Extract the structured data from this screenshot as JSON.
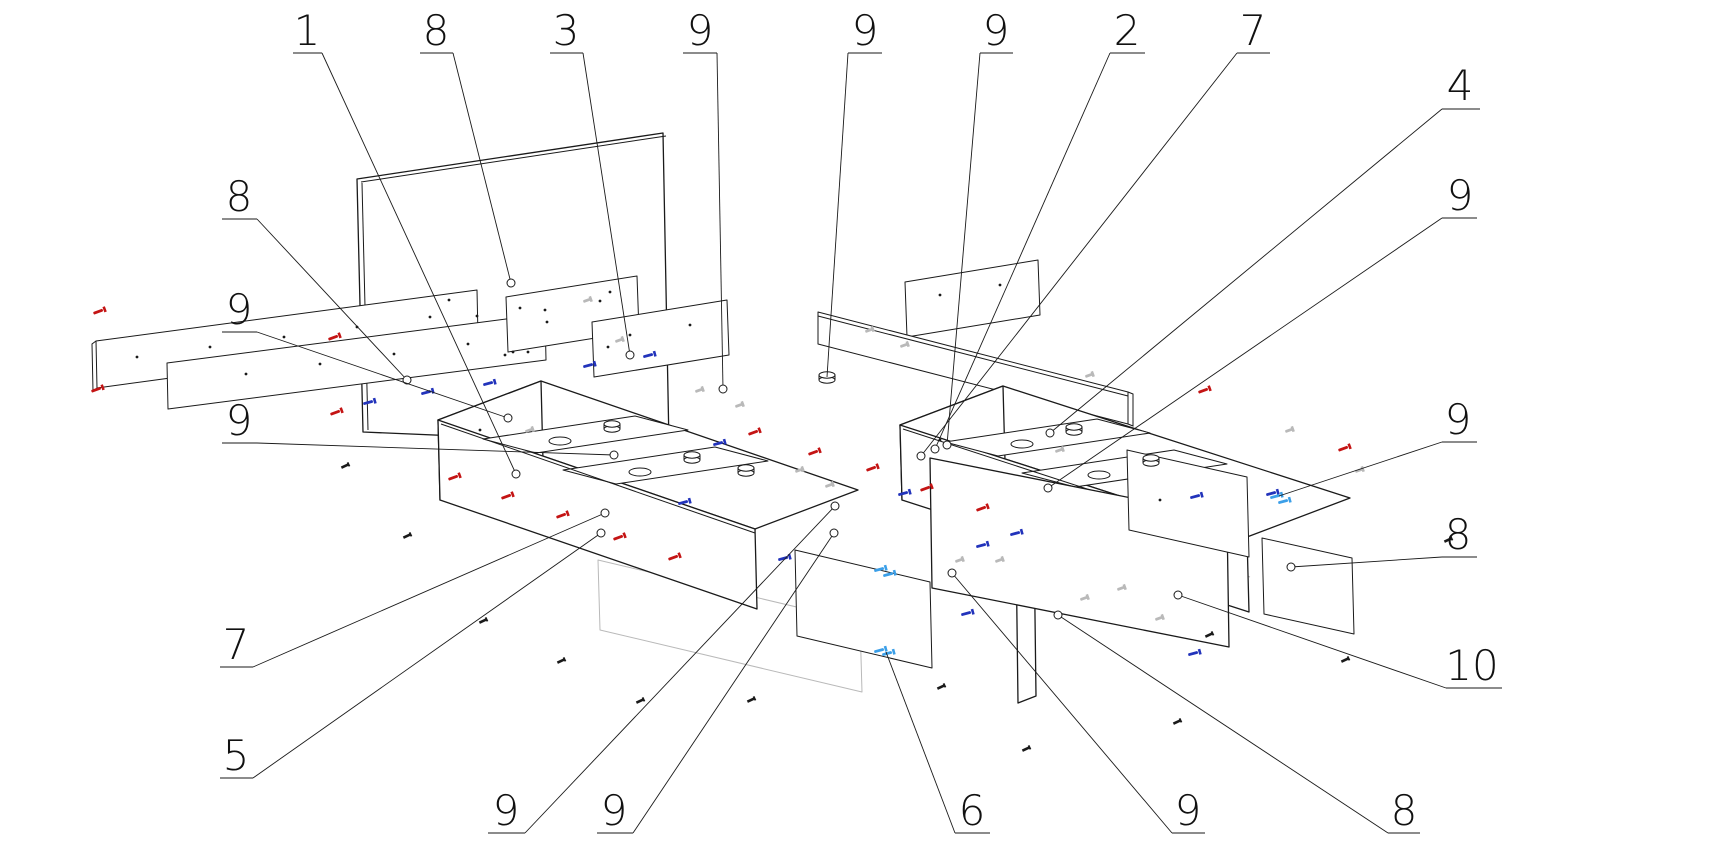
{
  "diagram": {
    "type": "exploded-assembly-technical-drawing",
    "subject": "bed frame with drawer boxes, exploded isometric view",
    "colors": {
      "line": "#1a1a1a",
      "hidden": "#b9b9b9",
      "screw_red": "#c41414",
      "screw_blue": "#2233bb",
      "screw_lightblue": "#3b9fe8",
      "background": "#ffffff"
    },
    "callouts": [
      {
        "label": "1",
        "tx": 307,
        "ty": 45,
        "ux1": 293,
        "ux2": 322,
        "uy": 53,
        "sx": 322,
        "sy": 53,
        "ex": 516,
        "ey": 474,
        "circle": true
      },
      {
        "label": "8",
        "tx": 436,
        "ty": 45,
        "ux1": 420,
        "ux2": 453,
        "uy": 53,
        "sx": 453,
        "sy": 53,
        "ex": 511,
        "ey": 283,
        "circle": true
      },
      {
        "label": "3",
        "tx": 566,
        "ty": 45,
        "ux1": 550,
        "ux2": 583,
        "uy": 53,
        "sx": 583,
        "sy": 53,
        "ex": 630,
        "ey": 355,
        "circle": true
      },
      {
        "label": "9",
        "tx": 700,
        "ty": 45,
        "ux1": 683,
        "ux2": 717,
        "uy": 53,
        "sx": 717,
        "sy": 53,
        "ex": 723,
        "ey": 389,
        "circle": true
      },
      {
        "label": "9",
        "tx": 865,
        "ty": 45,
        "ux1": 848,
        "ux2": 882,
        "uy": 53,
        "sx": 848,
        "sy": 53,
        "ex": 827,
        "ey": 377,
        "circle": false
      },
      {
        "label": "9",
        "tx": 996,
        "ty": 45,
        "ux1": 980,
        "ux2": 1013,
        "uy": 53,
        "sx": 980,
        "sy": 53,
        "ex": 947,
        "ey": 445,
        "circle": true
      },
      {
        "label": "2",
        "tx": 1127,
        "ty": 45,
        "ux1": 1110,
        "ux2": 1145,
        "uy": 53,
        "sx": 1110,
        "sy": 53,
        "ex": 935,
        "ey": 449,
        "circle": true
      },
      {
        "label": "7",
        "tx": 1253,
        "ty": 45,
        "ux1": 1237,
        "ux2": 1270,
        "uy": 53,
        "sx": 1237,
        "sy": 53,
        "ex": 921,
        "ey": 456,
        "circle": true
      },
      {
        "label": "4",
        "tx": 1460,
        "ty": 100,
        "ux1": 1442,
        "ux2": 1480,
        "uy": 109,
        "sx": 1442,
        "sy": 109,
        "ex": 1050,
        "ey": 433,
        "circle": true
      },
      {
        "label": "9",
        "tx": 1460,
        "ty": 210,
        "ux1": 1442,
        "ux2": 1477,
        "uy": 218,
        "sx": 1442,
        "sy": 218,
        "ex": 1048,
        "ey": 488,
        "circle": true
      },
      {
        "label": "9",
        "tx": 1458,
        "ty": 434,
        "ux1": 1442,
        "ux2": 1477,
        "uy": 442,
        "sx": 1442,
        "sy": 442,
        "ex": 1279,
        "ey": 496,
        "circle": false
      },
      {
        "label": "8",
        "tx": 1458,
        "ty": 549,
        "ux1": 1442,
        "ux2": 1477,
        "uy": 557,
        "sx": 1442,
        "sy": 557,
        "ex": 1291,
        "ey": 567,
        "circle": true
      },
      {
        "label": "10",
        "tx": 1472,
        "ty": 680,
        "ux1": 1446,
        "ux2": 1502,
        "uy": 688,
        "sx": 1446,
        "sy": 688,
        "ex": 1178,
        "ey": 595,
        "circle": true
      },
      {
        "label": "8",
        "tx": 239,
        "ty": 211,
        "ux1": 222,
        "ux2": 257,
        "uy": 219,
        "sx": 257,
        "sy": 219,
        "ex": 407,
        "ey": 380,
        "circle": true
      },
      {
        "label": "9",
        "tx": 239,
        "ty": 324,
        "ux1": 222,
        "ux2": 257,
        "uy": 332,
        "sx": 257,
        "sy": 332,
        "ex": 508,
        "ey": 418,
        "circle": true
      },
      {
        "label": "9",
        "tx": 239,
        "ty": 435,
        "ux1": 222,
        "ux2": 257,
        "uy": 443,
        "sx": 257,
        "sy": 443,
        "ex": 614,
        "ey": 455,
        "circle": true
      },
      {
        "label": "7",
        "tx": 236,
        "ty": 659,
        "ux1": 220,
        "ux2": 253,
        "uy": 667,
        "sx": 253,
        "sy": 667,
        "ex": 605,
        "ey": 513,
        "circle": true
      },
      {
        "label": "5",
        "tx": 236,
        "ty": 770,
        "ux1": 220,
        "ux2": 253,
        "uy": 778,
        "sx": 253,
        "sy": 778,
        "ex": 601,
        "ey": 533,
        "circle": true
      },
      {
        "label": "9",
        "tx": 506,
        "ty": 825,
        "ux1": 488,
        "ux2": 525,
        "uy": 833,
        "sx": 525,
        "sy": 833,
        "ex": 835,
        "ey": 506,
        "circle": true
      },
      {
        "label": "9",
        "tx": 614,
        "ty": 825,
        "ux1": 597,
        "ux2": 633,
        "uy": 833,
        "sx": 633,
        "sy": 833,
        "ex": 834,
        "ey": 533,
        "circle": true
      },
      {
        "label": "6",
        "tx": 972,
        "ty": 825,
        "ux1": 955,
        "ux2": 990,
        "uy": 833,
        "sx": 955,
        "sy": 833,
        "ex": 886,
        "ey": 652,
        "circle": false
      },
      {
        "label": "9",
        "tx": 1188,
        "ty": 825,
        "ux1": 1172,
        "ux2": 1205,
        "uy": 833,
        "sx": 1172,
        "sy": 833,
        "ex": 952,
        "ey": 573,
        "circle": true
      },
      {
        "label": "8",
        "tx": 1404,
        "ty": 825,
        "ux1": 1388,
        "ux2": 1420,
        "uy": 833,
        "sx": 1388,
        "sy": 833,
        "ex": 1058,
        "ey": 615,
        "circle": true
      }
    ],
    "fasteners": {
      "red": [
        [
          100,
          311,
          -20
        ],
        [
          98,
          389,
          -20
        ],
        [
          335,
          337,
          -20
        ],
        [
          337,
          412,
          -20
        ],
        [
          455,
          477,
          -20
        ],
        [
          508,
          496,
          -20
        ],
        [
          563,
          515,
          -20
        ],
        [
          620,
          537,
          -20
        ],
        [
          675,
          557,
          -20
        ],
        [
          755,
          432,
          -20
        ],
        [
          815,
          452,
          -20
        ],
        [
          873,
          468,
          -20
        ],
        [
          927,
          488,
          -20
        ],
        [
          983,
          508,
          -20
        ],
        [
          1205,
          390,
          -20
        ],
        [
          1345,
          448,
          -20
        ]
      ],
      "blue": [
        [
          370,
          402,
          -15
        ],
        [
          428,
          392,
          -15
        ],
        [
          490,
          383,
          -15
        ],
        [
          590,
          365,
          -15
        ],
        [
          650,
          355,
          -15
        ],
        [
          685,
          502,
          -15
        ],
        [
          720,
          443,
          -15
        ],
        [
          785,
          558,
          -15
        ],
        [
          905,
          493,
          -15
        ],
        [
          983,
          545,
          -15
        ],
        [
          1017,
          533,
          -15
        ],
        [
          968,
          613,
          -15
        ],
        [
          1197,
          496,
          -15
        ],
        [
          1273,
          493,
          -15
        ],
        [
          1195,
          653,
          -15
        ]
      ],
      "lightblue": [
        [
          881,
          569,
          -15
        ],
        [
          890,
          574,
          -15
        ],
        [
          881,
          650,
          -15
        ],
        [
          889,
          653,
          -15
        ],
        [
          1277,
          496,
          -15
        ],
        [
          1285,
          501,
          -15
        ]
      ],
      "grey": [
        [
          588,
          300,
          -20
        ],
        [
          620,
          340,
          -20
        ],
        [
          870,
          330,
          -20
        ],
        [
          905,
          345,
          -20
        ],
        [
          1090,
          375,
          -20
        ],
        [
          800,
          470,
          -20
        ],
        [
          830,
          485,
          -20
        ],
        [
          1290,
          430,
          -20
        ],
        [
          960,
          560,
          -20
        ],
        [
          1000,
          560,
          -20
        ],
        [
          1085,
          598,
          -20
        ],
        [
          1122,
          588,
          -20
        ],
        [
          1160,
          618,
          -20
        ],
        [
          700,
          390,
          -20
        ],
        [
          740,
          405,
          -20
        ],
        [
          1360,
          470,
          -20
        ],
        [
          530,
          430,
          -20
        ],
        [
          1060,
          450,
          -20
        ]
      ]
    },
    "floor_debris": [
      [
        345,
        466
      ],
      [
        407,
        536
      ],
      [
        483,
        621
      ],
      [
        561,
        661
      ],
      [
        640,
        701
      ],
      [
        751,
        700
      ],
      [
        941,
        687
      ],
      [
        1026,
        749
      ],
      [
        1177,
        722
      ],
      [
        1209,
        635
      ],
      [
        1345,
        660
      ],
      [
        1448,
        540
      ]
    ],
    "cylinders": [
      [
        612,
        424
      ],
      [
        692,
        455
      ],
      [
        1074,
        427
      ],
      [
        1151,
        458
      ],
      [
        827,
        375
      ],
      [
        746,
        468
      ]
    ],
    "handle_slots": [
      [
        560,
        441
      ],
      [
        640,
        472
      ],
      [
        1022,
        444
      ],
      [
        1099,
        475
      ]
    ],
    "holes": [
      [
        449,
        300
      ],
      [
        477,
        316
      ],
      [
        520,
        308
      ],
      [
        547,
        322
      ],
      [
        610,
        292
      ],
      [
        137,
        357
      ],
      [
        210,
        347
      ],
      [
        284,
        337
      ],
      [
        357,
        327
      ],
      [
        430,
        317
      ],
      [
        246,
        374
      ],
      [
        320,
        364
      ],
      [
        394,
        354
      ],
      [
        468,
        344
      ],
      [
        545,
        310
      ],
      [
        600,
        301
      ],
      [
        630,
        335
      ],
      [
        690,
        325
      ],
      [
        940,
        295
      ],
      [
        1000,
        285
      ],
      [
        505,
        355
      ],
      [
        513,
        352
      ],
      [
        528,
        352
      ],
      [
        608,
        347
      ],
      [
        480,
        430
      ],
      [
        940,
        440
      ],
      [
        1160,
        500
      ]
    ]
  }
}
